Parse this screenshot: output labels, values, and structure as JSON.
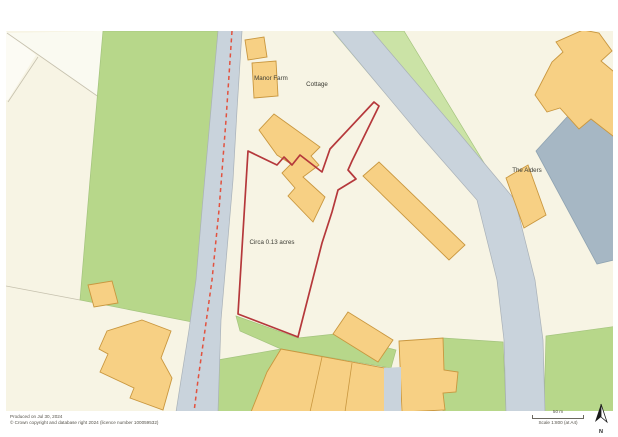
{
  "map": {
    "labels": {
      "manor_farm": "Manor Farm",
      "cottage": "Cottage",
      "plot_area": "Circa 0.13 acres",
      "the_alders": "The Alders"
    },
    "colors": {
      "background": "#f7f4e4",
      "field_green": "#b7d78a",
      "verge_green": "#cbe3a6",
      "road": "#c9d3dc",
      "building": "#f7d084",
      "building_outline": "#c9973f",
      "gray_building": "#a6b7c4",
      "plot_boundary_red": "#b5383b",
      "road_dash_red": "#e2523f"
    }
  },
  "footer": {
    "produced_on": "Produced on Jul 30, 2024",
    "copyright": "© Crown copyright and database right 2024 (licence number 100059532)"
  },
  "scale_bar": {
    "distance_label": "50 m",
    "scale_label": "Scale 1:800 (at A4)"
  },
  "compass": {
    "label": "N"
  }
}
